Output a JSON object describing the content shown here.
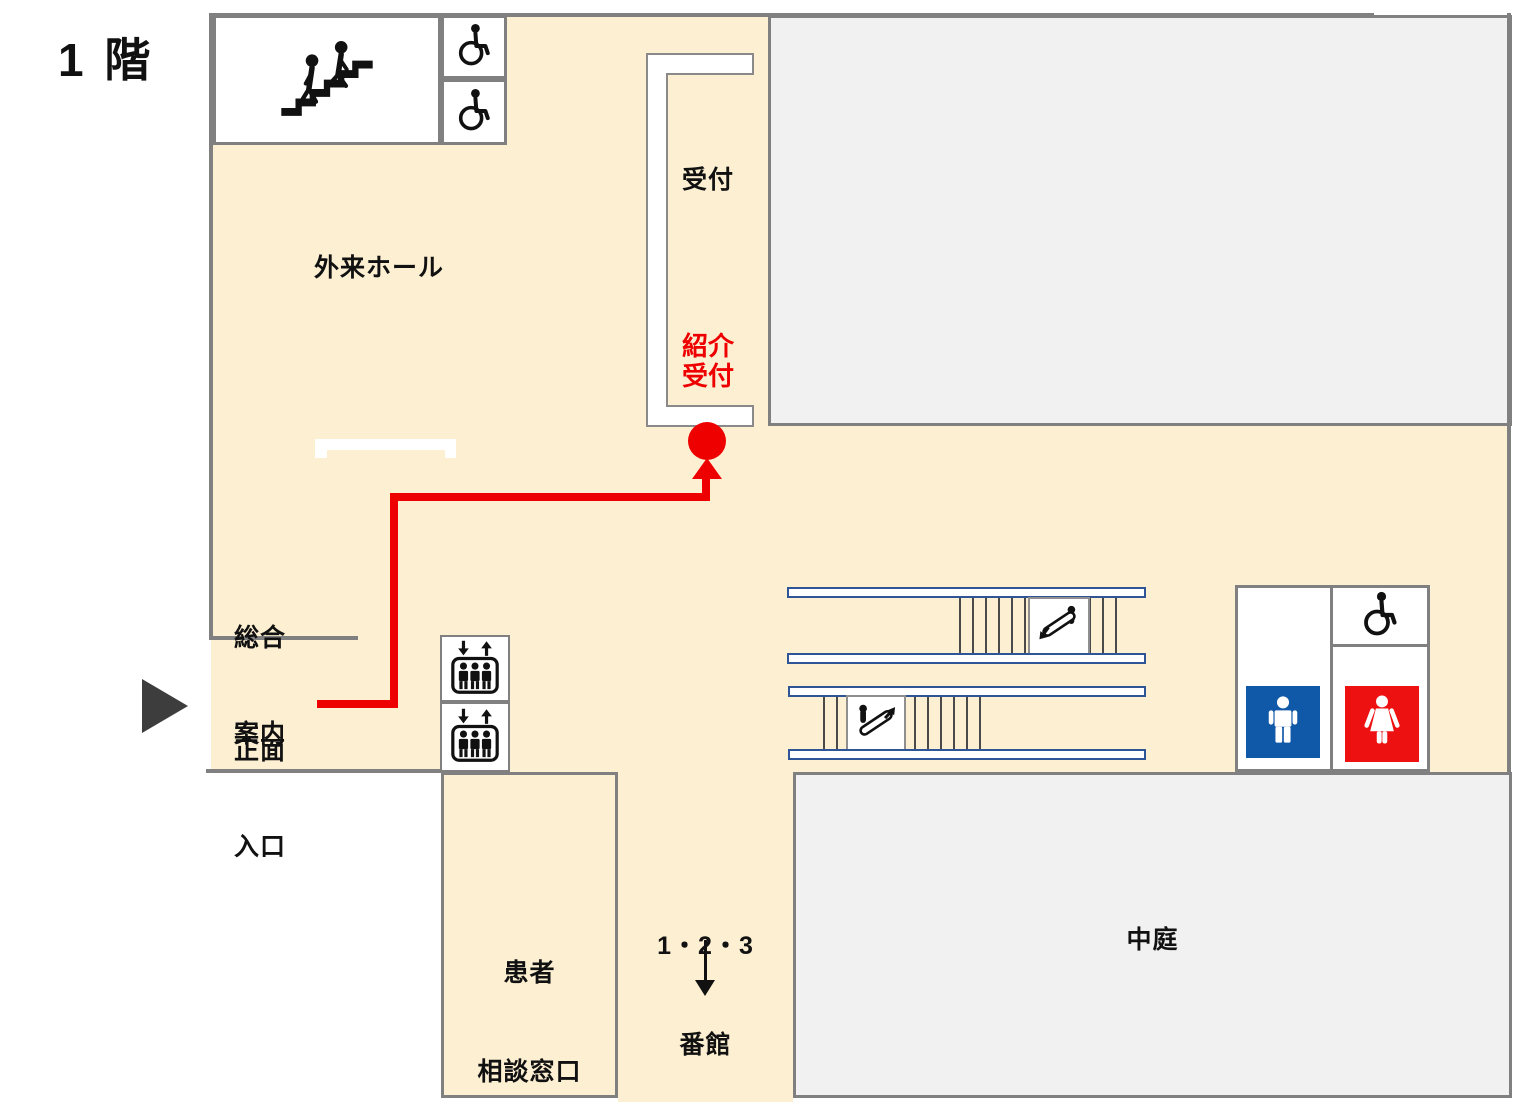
{
  "floor_label": "1 階",
  "labels": {
    "outpatient_hall": "外来ホール",
    "reception": "受付",
    "referral_reception": {
      "line1": "紹介",
      "line2": "受付"
    },
    "general_info": {
      "line1": "総合",
      "line2": "案内"
    },
    "main_entrance": {
      "line1": "正面",
      "line2": "入口"
    },
    "patient_consultation": {
      "line1": "患者",
      "line2": "相談窓口"
    },
    "buildings_123": {
      "line1": "1・2・3",
      "line2": "番館"
    },
    "courtyard": "中庭"
  },
  "icons": {
    "stairs": "stairs-with-two-people",
    "wheelchair": "wheelchair-accessible",
    "elevator": "elevator-with-up-down-arrows",
    "escalator_down": "escalator-going-down",
    "escalator_up": "escalator-going-up",
    "restroom_male": "male-figure",
    "restroom_female": "female-figure",
    "entrance_marker": "right-pointing-triangle",
    "destination_dot": "red-circle-destination",
    "route_arrow_up": "red-arrow-to-referral-reception",
    "corridor_arrow_down": "black-arrow-to-buildings"
  },
  "colors": {
    "floor_cream": "#FCEFD2",
    "building_gray": "#F1F1F1",
    "border_gray": "#808080",
    "route_red": "#EE0000",
    "escalator_rail_blue": "#2F5597",
    "male_blue": "#1058A8",
    "female_red": "#EE1111",
    "icon_black": "#111111",
    "entrance_triangle": "#3D3D3D"
  }
}
